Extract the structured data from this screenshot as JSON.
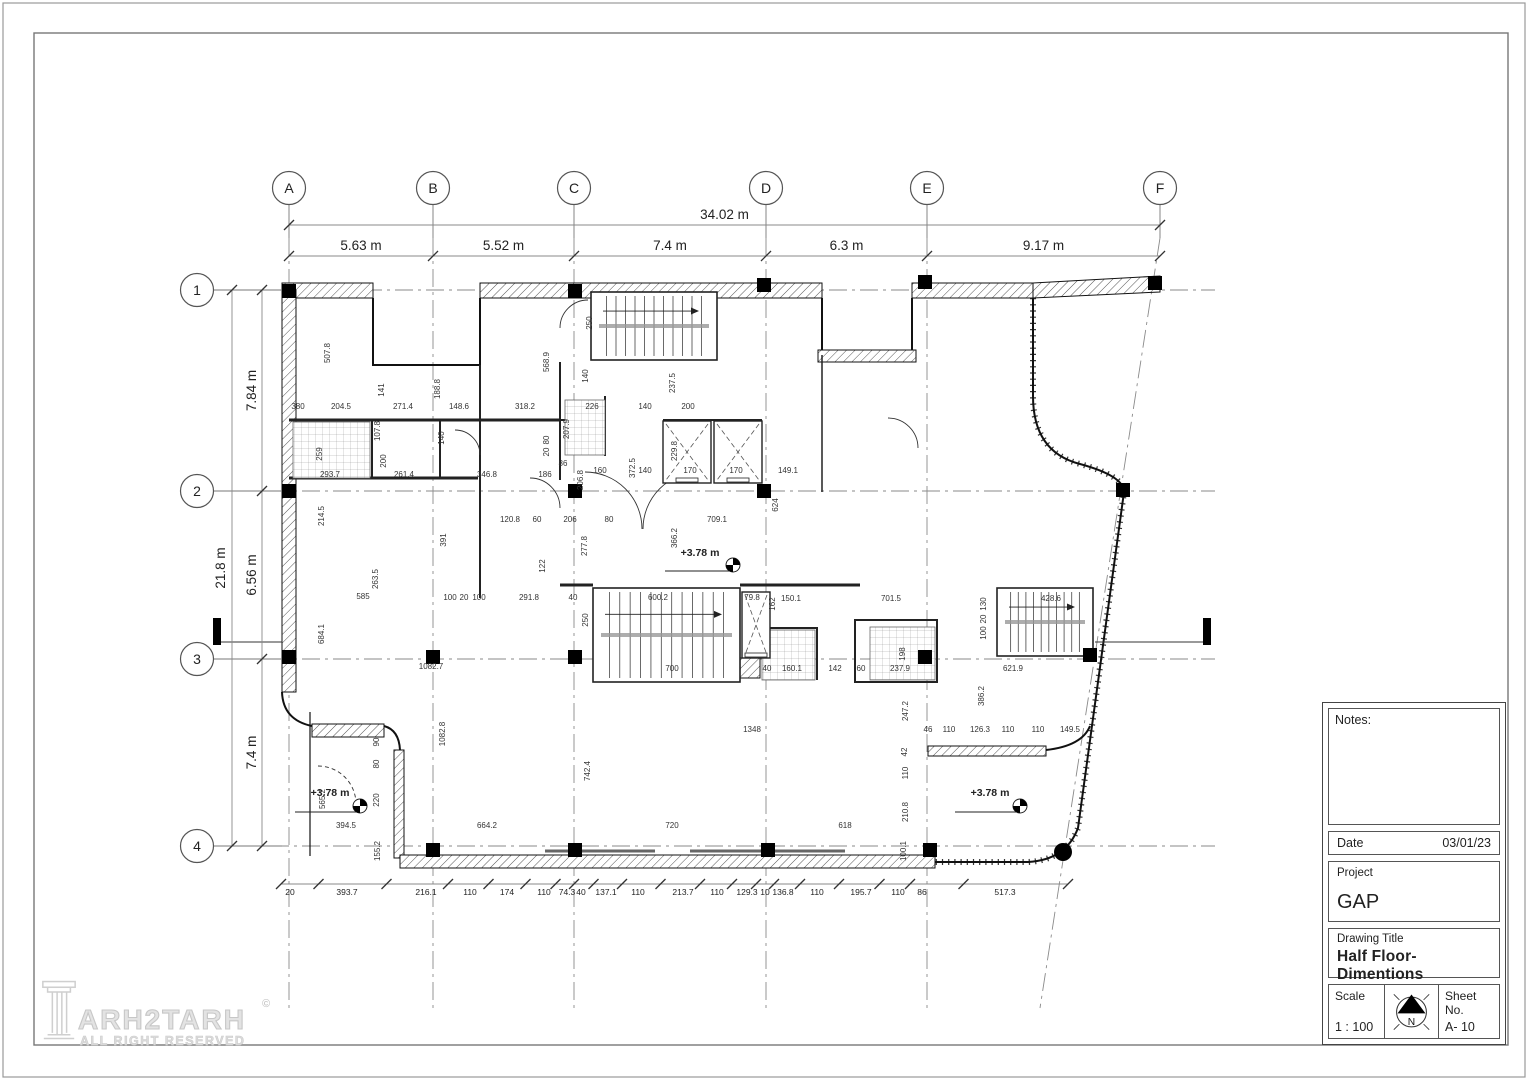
{
  "sheet": {
    "logo": {
      "brand": "ARH2TARH",
      "copyright": "©",
      "tagline": "ALL RIGHT RESERVED"
    },
    "title_block": {
      "notes_label": "Notes:",
      "date_label": "Date",
      "date_value": "03/01/23",
      "project_label": "Project",
      "project_value": "GAP",
      "drawing_title_label": "Drawing Title",
      "drawing_title_value": "Half Floor- Dimentions",
      "scale_label": "Scale",
      "scale_value": "1 : 100",
      "sheet_label": "Sheet No.",
      "sheet_value": "A- 10",
      "north_label": "N"
    }
  },
  "plan": {
    "grid_columns": [
      {
        "label": "A",
        "x": 289
      },
      {
        "label": "B",
        "x": 433
      },
      {
        "label": "C",
        "x": 574
      },
      {
        "label": "D",
        "x": 766
      },
      {
        "label": "E",
        "x": 927
      },
      {
        "label": "F",
        "x": 1160,
        "x_bottom": 1040
      }
    ],
    "grid_rows": [
      {
        "label": "1",
        "y": 290
      },
      {
        "label": "2",
        "y": 491
      },
      {
        "label": "3",
        "y": 659
      },
      {
        "label": "4",
        "y": 846
      }
    ],
    "dim_top_total": "34.02 m",
    "dim_top_segments": [
      "5.63 m",
      "5.52 m",
      "7.4 m",
      "6.3 m",
      "9.17 m"
    ],
    "dim_left_total": "21.8 m",
    "dim_left_segments": [
      "7.84 m",
      "6.56 m",
      "7.4 m"
    ],
    "dim_bottom": [
      {
        "t": "20",
        "x": 290
      },
      {
        "t": "393.7",
        "x": 347
      },
      {
        "t": "216.1",
        "x": 426
      },
      {
        "t": "110",
        "x": 470
      },
      {
        "t": "174",
        "x": 507
      },
      {
        "t": "110",
        "x": 544
      },
      {
        "t": "74.3",
        "x": 567
      },
      {
        "t": "40",
        "x": 581
      },
      {
        "t": "137.1",
        "x": 606
      },
      {
        "t": "110",
        "x": 638
      },
      {
        "t": "213.7",
        "x": 683
      },
      {
        "t": "110",
        "x": 717
      },
      {
        "t": "129.3",
        "x": 747
      },
      {
        "t": "10",
        "x": 765
      },
      {
        "t": "136.8",
        "x": 783
      },
      {
        "t": "110",
        "x": 817
      },
      {
        "t": "195.7",
        "x": 861
      },
      {
        "t": "110",
        "x": 898
      },
      {
        "t": "86",
        "x": 922
      },
      {
        "t": "517.3",
        "x": 1005
      }
    ],
    "level_markers": [
      {
        "t": "+3.78 m",
        "tx": 700,
        "ty": 556,
        "mx": 733,
        "my": 565
      },
      {
        "t": "+3.78 m",
        "tx": 330,
        "ty": 796,
        "mx": 360,
        "my": 806
      },
      {
        "t": "+3.78 m",
        "tx": 990,
        "ty": 796,
        "mx": 1020,
        "my": 806
      }
    ],
    "labels": [
      {
        "t": "507.8",
        "x": 330,
        "y": 353,
        "v": 1
      },
      {
        "t": "141",
        "x": 384,
        "y": 390,
        "v": 1
      },
      {
        "t": "188.8",
        "x": 440,
        "y": 389,
        "v": 1
      },
      {
        "t": "568.9",
        "x": 549,
        "y": 362,
        "v": 1
      },
      {
        "t": "250",
        "x": 592,
        "y": 323,
        "v": 1
      },
      {
        "t": "237.5",
        "x": 675,
        "y": 383,
        "v": 1
      },
      {
        "t": "107.8",
        "x": 380,
        "y": 431,
        "v": 1
      },
      {
        "t": "259",
        "x": 322,
        "y": 454,
        "v": 1
      },
      {
        "t": "200",
        "x": 386,
        "y": 461,
        "v": 1
      },
      {
        "t": "207.9",
        "x": 569,
        "y": 429,
        "v": 1
      },
      {
        "t": "140",
        "x": 588,
        "y": 376,
        "v": 1
      },
      {
        "t": "372.5",
        "x": 635,
        "y": 468,
        "v": 1
      },
      {
        "t": "206.8",
        "x": 583,
        "y": 480,
        "v": 1
      },
      {
        "t": "229.8",
        "x": 677,
        "y": 451,
        "v": 1
      },
      {
        "t": "140",
        "x": 444,
        "y": 438,
        "v": 1
      },
      {
        "t": "624",
        "x": 778,
        "y": 505,
        "v": 1
      },
      {
        "t": "366.2",
        "x": 677,
        "y": 538,
        "v": 1
      },
      {
        "t": "277.8",
        "x": 587,
        "y": 546,
        "v": 1
      },
      {
        "t": "122",
        "x": 545,
        "y": 566,
        "v": 1
      },
      {
        "t": "391",
        "x": 446,
        "y": 540,
        "v": 1
      },
      {
        "t": "214.5",
        "x": 324,
        "y": 516,
        "v": 1
      },
      {
        "t": "263.5",
        "x": 378,
        "y": 579,
        "v": 1
      },
      {
        "t": "684.1",
        "x": 324,
        "y": 634,
        "v": 1
      },
      {
        "t": "250",
        "x": 588,
        "y": 620,
        "v": 1
      },
      {
        "t": "1082.8",
        "x": 445,
        "y": 734,
        "v": 1
      },
      {
        "t": "742.4",
        "x": 590,
        "y": 771,
        "v": 1
      },
      {
        "t": "162",
        "x": 775,
        "y": 604,
        "v": 1
      },
      {
        "t": "198",
        "x": 905,
        "y": 654,
        "v": 1
      },
      {
        "t": "130",
        "x": 986,
        "y": 604,
        "v": 1
      },
      {
        "t": "20",
        "x": 986,
        "y": 619,
        "v": 1
      },
      {
        "t": "100",
        "x": 986,
        "y": 633,
        "v": 1
      },
      {
        "t": "386.2",
        "x": 984,
        "y": 696,
        "v": 1
      },
      {
        "t": "247.2",
        "x": 908,
        "y": 711,
        "v": 1
      },
      {
        "t": "42",
        "x": 907,
        "y": 752,
        "v": 1
      },
      {
        "t": "110",
        "x": 908,
        "y": 773,
        "v": 1
      },
      {
        "t": "210.8",
        "x": 908,
        "y": 812,
        "v": 1
      },
      {
        "t": "100.1",
        "x": 906,
        "y": 851,
        "v": 1
      },
      {
        "t": "90",
        "x": 379,
        "y": 742,
        "v": 1
      },
      {
        "t": "80",
        "x": 379,
        "y": 764,
        "v": 1
      },
      {
        "t": "220",
        "x": 379,
        "y": 800,
        "v": 1
      },
      {
        "t": "155.2",
        "x": 380,
        "y": 851,
        "v": 1
      },
      {
        "t": "565.2",
        "x": 325,
        "y": 799,
        "v": 1
      },
      {
        "t": "80",
        "x": 549,
        "y": 440,
        "v": 1
      },
      {
        "t": "20",
        "x": 549,
        "y": 452,
        "v": 1
      },
      {
        "t": "380",
        "x": 298,
        "y": 409
      },
      {
        "t": "204.5",
        "x": 341,
        "y": 409
      },
      {
        "t": "271.4",
        "x": 403,
        "y": 409
      },
      {
        "t": "148.6",
        "x": 459,
        "y": 409
      },
      {
        "t": "318.2",
        "x": 525,
        "y": 409
      },
      {
        "t": "226",
        "x": 592,
        "y": 409
      },
      {
        "t": "140",
        "x": 645,
        "y": 409
      },
      {
        "t": "200",
        "x": 688,
        "y": 409
      },
      {
        "t": "293.7",
        "x": 330,
        "y": 477
      },
      {
        "t": "261.4",
        "x": 404,
        "y": 477
      },
      {
        "t": "346.8",
        "x": 487,
        "y": 477
      },
      {
        "t": "186",
        "x": 545,
        "y": 477
      },
      {
        "t": "86",
        "x": 563,
        "y": 466
      },
      {
        "t": "160",
        "x": 600,
        "y": 473
      },
      {
        "t": "140",
        "x": 645,
        "y": 473
      },
      {
        "t": "170",
        "x": 690,
        "y": 473
      },
      {
        "t": "170",
        "x": 736,
        "y": 473
      },
      {
        "t": "149.1",
        "x": 788,
        "y": 473
      },
      {
        "t": "120.8",
        "x": 510,
        "y": 522
      },
      {
        "t": "60",
        "x": 537,
        "y": 522
      },
      {
        "t": "206",
        "x": 570,
        "y": 522
      },
      {
        "t": "80",
        "x": 609,
        "y": 522
      },
      {
        "t": "709.1",
        "x": 717,
        "y": 522
      },
      {
        "t": "585",
        "x": 363,
        "y": 599
      },
      {
        "t": "100",
        "x": 450,
        "y": 600
      },
      {
        "t": "20",
        "x": 464,
        "y": 600
      },
      {
        "t": "100",
        "x": 479,
        "y": 600
      },
      {
        "t": "291.8",
        "x": 529,
        "y": 600
      },
      {
        "t": "40",
        "x": 573,
        "y": 600
      },
      {
        "t": "600.2",
        "x": 658,
        "y": 600
      },
      {
        "t": "79.8",
        "x": 752,
        "y": 600
      },
      {
        "t": "150.1",
        "x": 791,
        "y": 601
      },
      {
        "t": "701.5",
        "x": 891,
        "y": 601
      },
      {
        "t": "428.6",
        "x": 1051,
        "y": 601
      },
      {
        "t": "1082.7",
        "x": 431,
        "y": 669
      },
      {
        "t": "700",
        "x": 672,
        "y": 671
      },
      {
        "t": "40",
        "x": 767,
        "y": 671
      },
      {
        "t": "160.1",
        "x": 792,
        "y": 671
      },
      {
        "t": "142",
        "x": 835,
        "y": 671
      },
      {
        "t": "60",
        "x": 861,
        "y": 671
      },
      {
        "t": "237.9",
        "x": 900,
        "y": 671
      },
      {
        "t": "621.9",
        "x": 1013,
        "y": 671
      },
      {
        "t": "1348",
        "x": 752,
        "y": 732
      },
      {
        "t": "46",
        "x": 928,
        "y": 732
      },
      {
        "t": "110",
        "x": 949,
        "y": 732
      },
      {
        "t": "126.3",
        "x": 980,
        "y": 732
      },
      {
        "t": "110",
        "x": 1008,
        "y": 732
      },
      {
        "t": "110",
        "x": 1038,
        "y": 732
      },
      {
        "t": "149.5",
        "x": 1070,
        "y": 732
      },
      {
        "t": "394.5",
        "x": 346,
        "y": 828
      },
      {
        "t": "664.2",
        "x": 487,
        "y": 828
      },
      {
        "t": "720",
        "x": 672,
        "y": 828
      },
      {
        "t": "618",
        "x": 845,
        "y": 828
      }
    ],
    "stairs": [
      {
        "x": 591,
        "y": 292,
        "w": 126,
        "h": 68,
        "treads": 12
      },
      {
        "x": 593,
        "y": 588,
        "w": 147,
        "h": 94,
        "treads": 13
      },
      {
        "x": 997,
        "y": 588,
        "w": 96,
        "h": 68,
        "treads": 11
      }
    ],
    "elevators": [
      {
        "x": 663,
        "y": 421,
        "w": 48,
        "h": 62
      },
      {
        "x": 714,
        "y": 421,
        "w": 48,
        "h": 62
      },
      {
        "x": 742,
        "y": 592,
        "w": 28,
        "h": 66
      }
    ],
    "tiled_rooms": [
      {
        "x": 293,
        "y": 422,
        "w": 77,
        "h": 56
      },
      {
        "x": 565,
        "y": 400,
        "w": 40,
        "h": 55
      },
      {
        "x": 870,
        "y": 627,
        "w": 65,
        "h": 53
      },
      {
        "x": 762,
        "y": 630,
        "w": 53,
        "h": 50
      }
    ],
    "columns_px": [
      [
        289,
        291
      ],
      [
        575,
        291
      ],
      [
        764,
        285
      ],
      [
        925,
        282
      ],
      [
        1155,
        283
      ],
      [
        289,
        491
      ],
      [
        575,
        491
      ],
      [
        764,
        491
      ],
      [
        1123,
        490
      ],
      [
        289,
        657
      ],
      [
        433,
        657
      ],
      [
        575,
        657
      ],
      [
        925,
        657
      ],
      [
        1090,
        655
      ],
      [
        433,
        850
      ],
      [
        575,
        850
      ],
      [
        768,
        850
      ],
      [
        930,
        850
      ]
    ],
    "round_column": [
      1063,
      852
    ],
    "section_markers": [
      [
        213,
        618
      ],
      [
        1203,
        618
      ]
    ]
  }
}
